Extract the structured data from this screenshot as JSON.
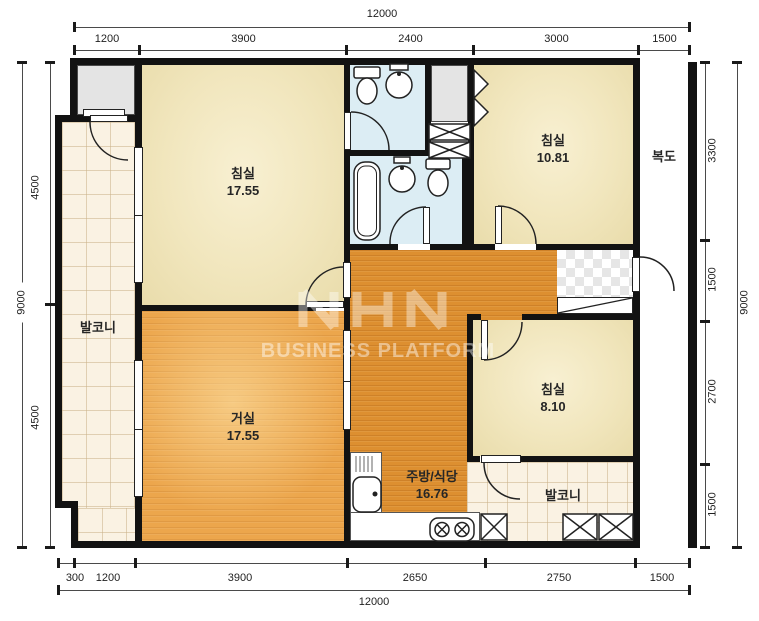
{
  "plan_type": "apartment-floor-plan",
  "watermark": {
    "logo": "NHN",
    "text": "BUSINESS PLATFORM"
  },
  "rooms": {
    "bedroom_main": {
      "label": "침실",
      "area": "17.55"
    },
    "bedroom_right": {
      "label": "침실",
      "area": "10.81"
    },
    "bedroom_small": {
      "label": "침실",
      "area": "8.10"
    },
    "living": {
      "label": "거실",
      "area": "17.55"
    },
    "kitchen": {
      "label": "주방/식당",
      "area": "16.76"
    },
    "balcony_left": {
      "label": "발코니"
    },
    "balcony_bottom": {
      "label": "발코니"
    },
    "corridor": {
      "label": "복도"
    }
  },
  "dimensions": {
    "top": {
      "total": "12000",
      "segments": [
        "1200",
        "3900",
        "2400",
        "3000",
        "1500"
      ]
    },
    "bottom": {
      "total": "12000",
      "segments": [
        "300",
        "1200",
        "3900",
        "2650",
        "2750",
        "1500"
      ]
    },
    "left": {
      "total": "9000",
      "segments": [
        "4500",
        "4500"
      ]
    },
    "right": {
      "total": "9000",
      "segments": [
        "3300",
        "1500",
        "2700",
        "1500"
      ]
    }
  },
  "colors": {
    "wall": "#121212",
    "wood_light": "#eca64c",
    "wood_dark": "#dd8f30",
    "bedroom_cream": "#f1e6bd",
    "balcony_tile": "#faf2e3",
    "bathroom_blue": "#dcedf4",
    "closet_gray": "#e4e4e4",
    "watermark_white": "rgba(255,255,255,0.45)"
  }
}
